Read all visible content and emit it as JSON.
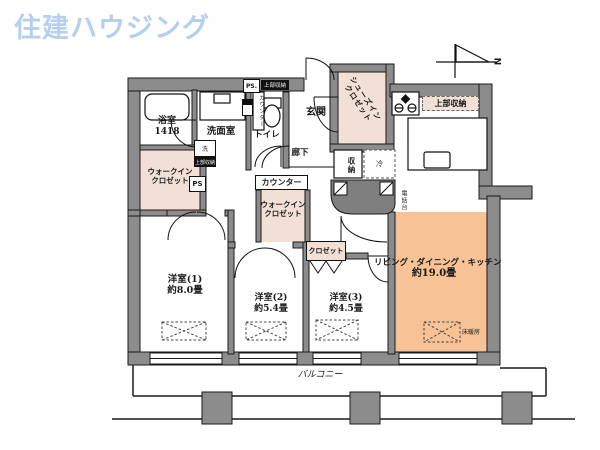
{
  "logo": {
    "text": "住建ハウジング",
    "color": "#b6cfee"
  },
  "compass": {
    "north": "N"
  },
  "plan": {
    "bath": {
      "label": "浴室",
      "size": "1418"
    },
    "washroom": {
      "label": "洗面室"
    },
    "toilet": {
      "label": "トイレ"
    },
    "counter": {
      "label": "カウンター"
    },
    "entrance": {
      "label": "玄関"
    },
    "shoes_in_closet": {
      "line1": "シューズイン",
      "line2": "クロゼット"
    },
    "hallway": {
      "label": "廊下"
    },
    "walk_in_closet": {
      "line1": "ウォークイン",
      "line2": "クロゼット"
    },
    "closet": {
      "label": "クロゼット"
    },
    "storage": {
      "label": "収納"
    },
    "refrigerator": {
      "label": "冷"
    },
    "phone_stand": {
      "label": "電話台"
    },
    "upper_storage": {
      "label": "上部収納"
    },
    "washer": {
      "label": "洗"
    },
    "ps": {
      "label": "PS"
    },
    "ps_dot": {
      "label": "PS."
    },
    "room1": {
      "name": "洋室(1)",
      "area": "約8.0畳"
    },
    "room2": {
      "name": "洋室(2)",
      "area": "約5.4畳"
    },
    "room3": {
      "name": "洋室(3)",
      "area": "約4.5畳"
    },
    "ldk": {
      "name": "リビング・ダイニング・キッチン",
      "area": "約19.0畳"
    },
    "floor_heating": {
      "label": "床暖房"
    },
    "balcony": {
      "label": "バルコニー"
    }
  },
  "colors": {
    "wall": "#8c8c8c",
    "closet_fill": "#f2dfd6",
    "ldk_fill": "#f6c296"
  }
}
